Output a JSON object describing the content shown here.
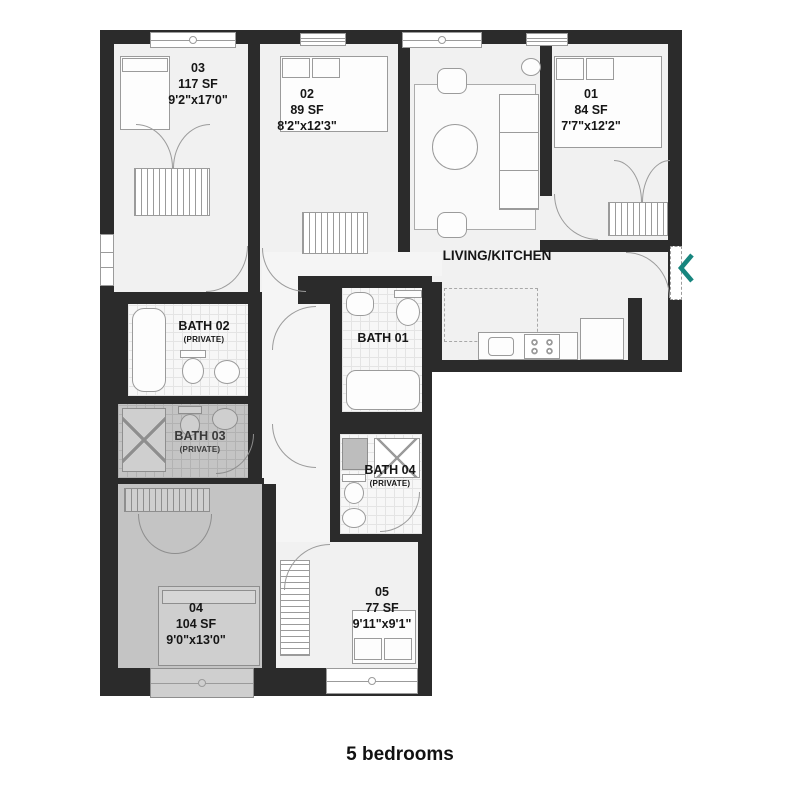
{
  "plan": {
    "living_label": "LIVING/KITCHEN",
    "rooms": [
      {
        "id": "01",
        "area": "84 SF",
        "dims": "7'7\"x12'2\""
      },
      {
        "id": "02",
        "area": "89 SF",
        "dims": "8'2\"x12'3\""
      },
      {
        "id": "03",
        "area": "117 SF",
        "dims": "9'2\"x17'0\""
      },
      {
        "id": "04",
        "area": "104 SF",
        "dims": "9'0\"x13'0\""
      },
      {
        "id": "05",
        "area": "77 SF",
        "dims": "9'11\"x9'1\""
      }
    ],
    "baths": [
      {
        "name": "BATH 01",
        "private": ""
      },
      {
        "name": "BATH 02",
        "private": "(PRIVATE)"
      },
      {
        "name": "BATH 03",
        "private": "(PRIVATE)"
      },
      {
        "name": "BATH 04",
        "private": "(PRIVATE)"
      }
    ],
    "highlighted_room": "04"
  },
  "caption": "5 bedrooms",
  "nav": {
    "prev_icon": "chevron-left"
  },
  "colors": {
    "wall": "#2b2b2b",
    "highlight": "#c4c4c4",
    "accent_teal": "#17857e"
  }
}
